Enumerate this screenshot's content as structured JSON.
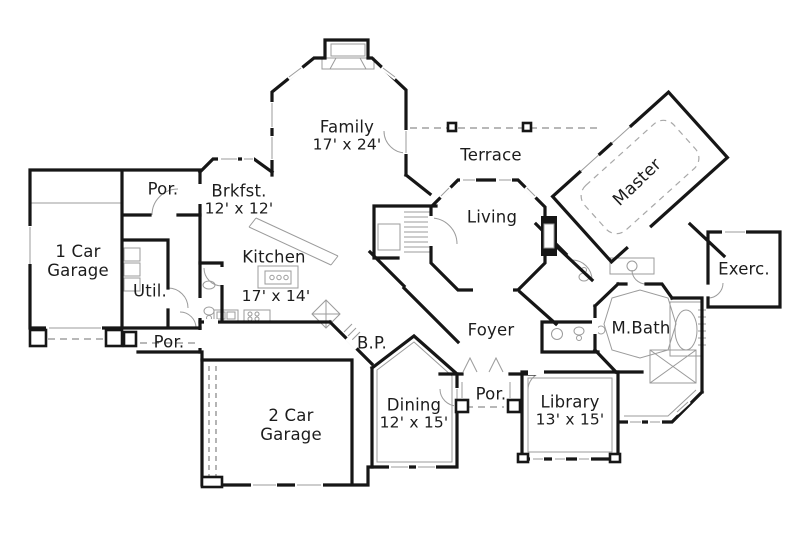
{
  "colors": {
    "background": "#ffffff",
    "walls": "#161616",
    "details": "#9b9b9b",
    "text": "#1c1c1c"
  },
  "rooms": {
    "family": {
      "label": "Family",
      "dims": "17' x 24'"
    },
    "terrace": {
      "label": "Terrace"
    },
    "master": {
      "label": "Master"
    },
    "por_top": {
      "label": "Por."
    },
    "brkfst": {
      "label": "Brkfst.",
      "dims": "12' x 12'"
    },
    "garage1": {
      "label": "1 Car Garage"
    },
    "living": {
      "label": "Living"
    },
    "exerc": {
      "label": "Exerc."
    },
    "util": {
      "label": "Util."
    },
    "kitchen": {
      "label": "Kitchen",
      "dims": "17' x 14'"
    },
    "mbath": {
      "label": "M.Bath"
    },
    "foyer": {
      "label": "Foyer"
    },
    "por_bottom_left": {
      "label": "Por."
    },
    "bp": {
      "label": "B.P."
    },
    "por_front": {
      "label": "Por."
    },
    "garage2": {
      "label": "2 Car Garage"
    },
    "dining": {
      "label": "Dining",
      "dims": "12' x 15'"
    },
    "library": {
      "label": "Library",
      "dims": "13' x 15'"
    }
  }
}
